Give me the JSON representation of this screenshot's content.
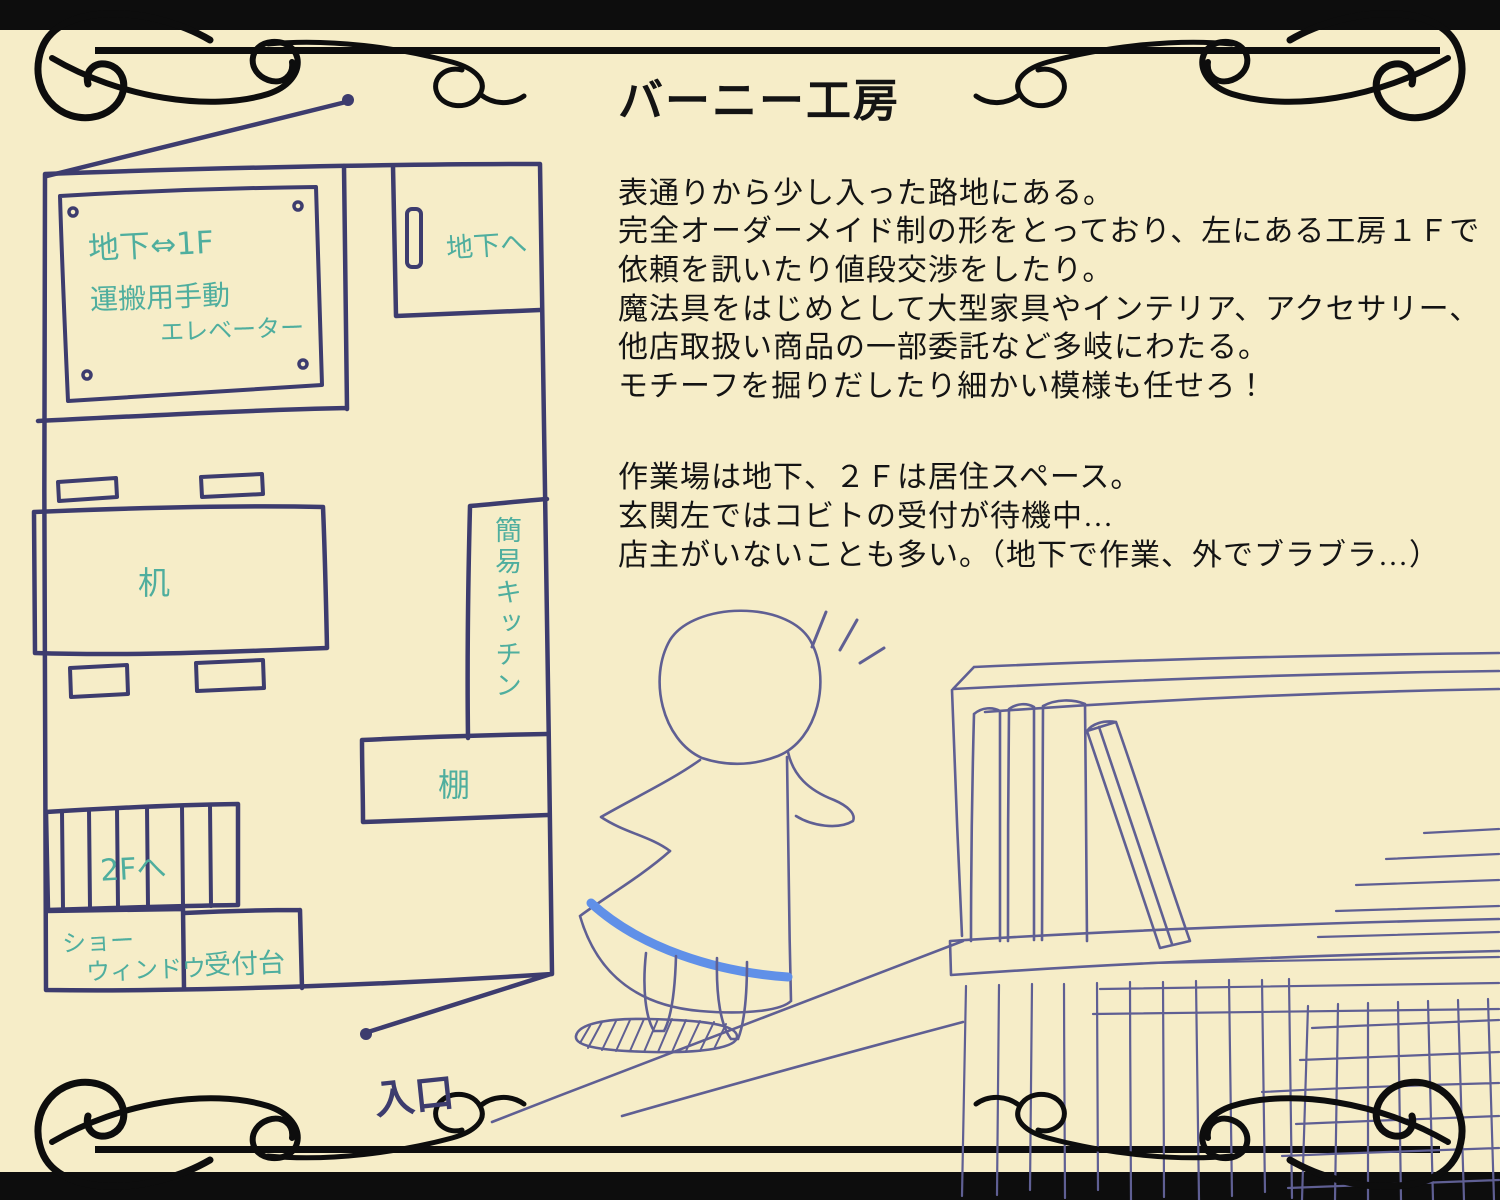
{
  "title": "バーニー工房",
  "description": {
    "paragraph1": [
      "表通りから少し入った路地にある。",
      "完全オーダーメイド制の形をとっており、左にある工房１Ｆで",
      "依頼を訊いたり値段交渉をしたり。",
      "魔法具をはじめとして大型家具やインテリア、アクセサリー、",
      "他店取扱い商品の一部委託など多岐にわたる。",
      "モチーフを掘りだしたり細かい模様も任せろ！"
    ],
    "paragraph2": [
      "作業場は地下、２Ｆは居住スペース。",
      "玄関左ではコビトの受付が待機中…",
      "店主がいないことも多い。（地下で作業、外でブラブラ…）"
    ]
  },
  "floor_plan": {
    "elevator_sign": {
      "line1": "地下⇔1F",
      "line2": "運搬用手動",
      "line3": "エレベーター"
    },
    "labels": {
      "to_basement": "地下へ",
      "desk": "机",
      "kitchen": "簡易キッチン",
      "shelf": "棚",
      "to_2f": "2Fへ",
      "show_window_line1": "ショー",
      "show_window_line2": "ウィンドウ",
      "reception": "受付台",
      "entrance": "入口"
    }
  },
  "colors": {
    "background": "#f6edc8",
    "frame": "#0d0d0d",
    "plan_ink": "#3d3c6e",
    "label_teal": "#4fae9e",
    "sketch_ink": "#5f5f93",
    "stripe_blue": "#6090e8",
    "text": "#141414"
  }
}
